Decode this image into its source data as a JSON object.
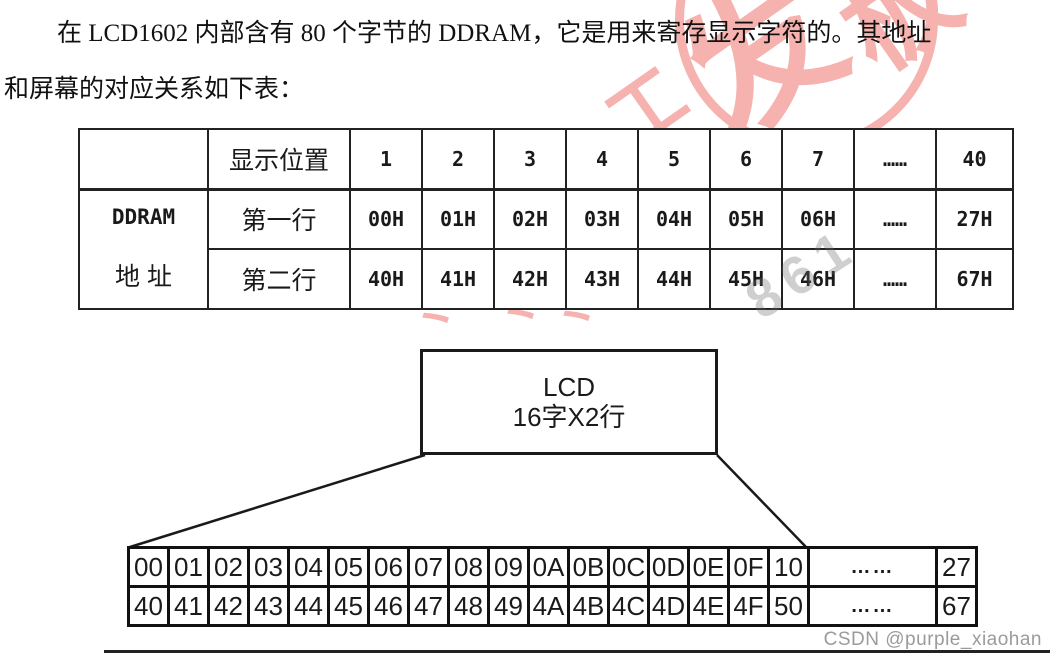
{
  "document": {
    "paragraph_line1": "在 LCD1602 内部含有 80 个字节的 DDRAM，它是用来寄存显示字符的。其地址",
    "paragraph_line2": "和屏幕的对应关系如下表："
  },
  "address_table": {
    "row_group_label_line1": "DDRAM",
    "row_group_label_line2": "地  址",
    "position_header": "显示位置",
    "positions": [
      "1",
      "2",
      "3",
      "4",
      "5",
      "6",
      "7",
      "……",
      "40"
    ],
    "row1_label": "第一行",
    "row1_values": [
      "00H",
      "01H",
      "02H",
      "03H",
      "04H",
      "05H",
      "06H",
      "……",
      "27H"
    ],
    "row2_label": "第二行",
    "row2_values": [
      "40H",
      "41H",
      "42H",
      "43H",
      "44H",
      "45H",
      "46H",
      "……",
      "67H"
    ]
  },
  "diagram": {
    "lcd_label_line1": "LCD",
    "lcd_label_line2": "16字X2行",
    "ddram_row1": [
      "00",
      "01",
      "02",
      "03",
      "04",
      "05",
      "06",
      "07",
      "08",
      "09",
      "0A",
      "0B",
      "0C",
      "0D",
      "0E",
      "0F",
      "10",
      "……",
      "27"
    ],
    "ddram_row2": [
      "40",
      "41",
      "42",
      "43",
      "44",
      "45",
      "46",
      "47",
      "48",
      "49",
      "4A",
      "4B",
      "4C",
      "4D",
      "4E",
      "4F",
      "50",
      "……",
      "67"
    ]
  },
  "watermark": {
    "red_color": "#f5b2af",
    "fragment_char1": "发",
    "fragment_char2": "板",
    "fragment_char3": "工",
    "tick": "丶",
    "gray_text": "861",
    "credit": "CSDN @purple_xiaohan",
    "credit_color": "#9b9b9b"
  }
}
